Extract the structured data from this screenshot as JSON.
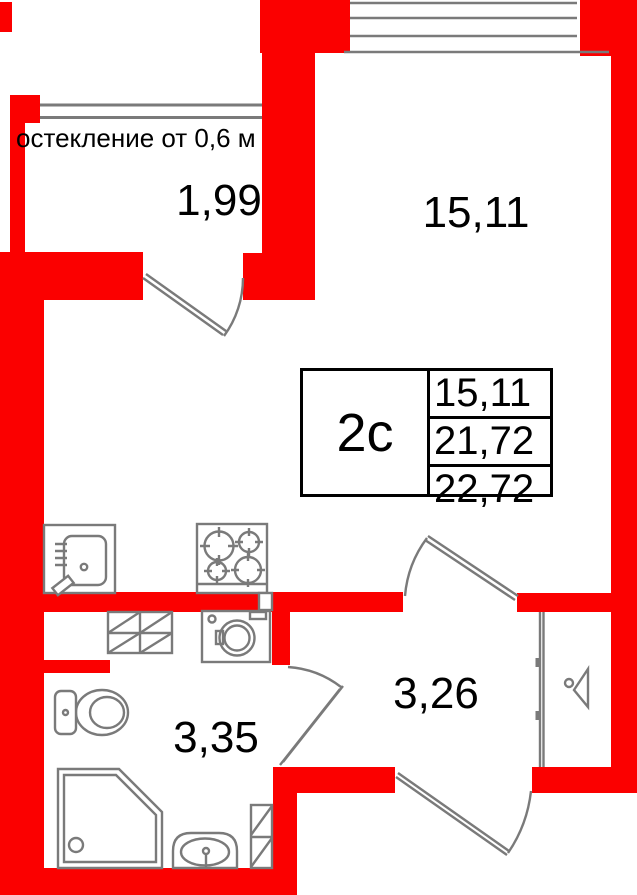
{
  "plan": {
    "glazing_note": "остекление от 0,6 м",
    "rooms": {
      "balcony": {
        "label": "1,99"
      },
      "living": {
        "label": "15,11"
      },
      "bathroom": {
        "label": "3,35"
      },
      "hallway": {
        "label": "3,26"
      }
    },
    "info_table": {
      "unit_type": "2с",
      "rows": [
        "15,11",
        "21,72",
        "22,72"
      ]
    },
    "colors": {
      "wall_red": "#fb0000",
      "line_gray": "#7a7a7a",
      "text_black": "#000000"
    }
  }
}
